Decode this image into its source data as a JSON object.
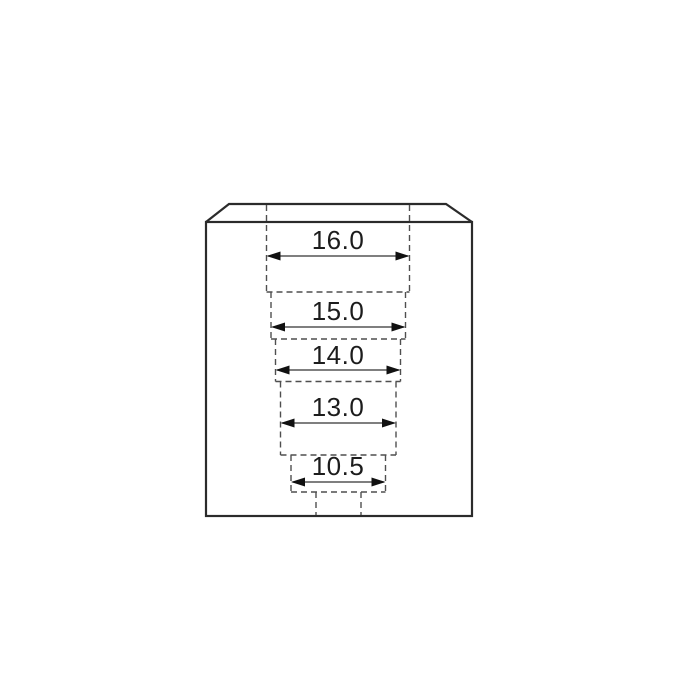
{
  "diagram": {
    "kind": "technical-drawing",
    "steps": [
      {
        "label": "16.0",
        "value": 16.0
      },
      {
        "label": "15.0",
        "value": 15.0
      },
      {
        "label": "14.0",
        "value": 14.0
      },
      {
        "label": "13.0",
        "value": 13.0
      },
      {
        "label": "10.5",
        "value": 10.5
      }
    ],
    "colors": {
      "background": "#ffffff",
      "outline": "#2b2b2b",
      "hidden_line": "#4f4f4f",
      "dimension_text": "#1c1c1c",
      "arrowhead": "#111111"
    }
  }
}
